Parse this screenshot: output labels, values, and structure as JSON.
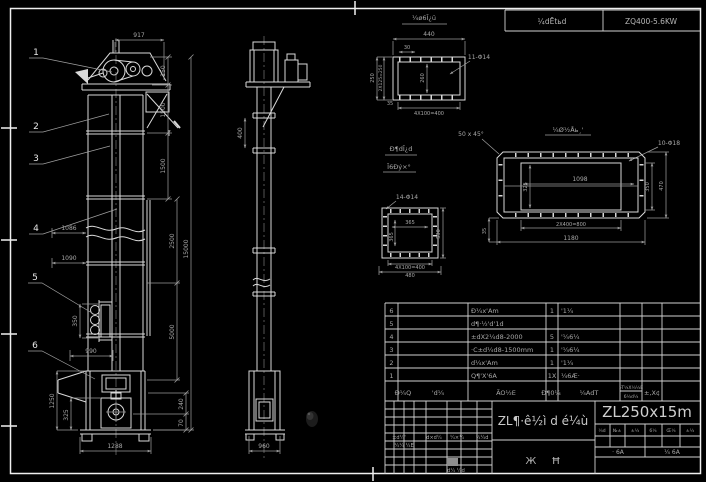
{
  "plate": {
    "left": "¼dĒtьd",
    "right": "ZQ400-5.6KW"
  },
  "front": {
    "callouts": [
      "1",
      "2",
      "3",
      "4",
      "5",
      "6"
    ],
    "section_mark": "I",
    "dims": {
      "w917": "917",
      "h150": "150",
      "h1500a": "1500",
      "h1500b": "1500",
      "v2500": "2500",
      "v5000": "5000",
      "v15000": "15000",
      "d1086": "1086",
      "d1090": "1090",
      "door350": "350",
      "d990": "990",
      "v1250": "1250",
      "v325": "325",
      "v240": "240",
      "v70": "70",
      "base1288": "1288"
    }
  },
  "side": {
    "dims": {
      "v400": "400",
      "base960": "960"
    }
  },
  "detail_a": {
    "title": "¼ø6Ī¿ü",
    "holes": "11-Φ14",
    "dims": {
      "w440": "440",
      "o30": "30",
      "i260": "260",
      "l250": "250",
      "l2x125": "2X125=250",
      "s35": "35",
      "b4x100": "4X100=400"
    }
  },
  "detail_b": {
    "title": "¼Ø½Åь¸'",
    "chamfer": "50 x 45°",
    "holes": "10-Φ18",
    "dims": {
      "i1098": "1098",
      "i325": "325",
      "r350": "350",
      "r470": "470",
      "b2x400": "2X400=800",
      "b1180": "1180",
      "l35": "35"
    }
  },
  "detail_c": {
    "title1": "Đ¶dĪ¿d",
    "title2": "Ī6Đý×°",
    "holes": "14-Φ14",
    "dims": {
      "iw": "365",
      "ih": "365",
      "r530": "530",
      "b1": "4X100=400",
      "b2": "480"
    }
  },
  "bom": {
    "header": {
      "no": "Đ¼Q",
      "code": "'d¼",
      "name": "ÃO½E",
      "qty": "Đ¶0¼",
      "material": "¼AdT",
      "weight_unit": "»T¼X¼½E",
      "weight_total": "6¼d¼",
      "remark": "±,X¢"
    },
    "rows": [
      {
        "no": "6",
        "code": "",
        "name": "Đ¼x'Am",
        "qty": "1",
        "material": "'1¼"
      },
      {
        "no": "5",
        "code": "",
        "name": "d¶·½'d'1d",
        "qty": "",
        "material": ""
      },
      {
        "no": "4",
        "code": "",
        "name": "±dX2¼d8-2000",
        "qty": "5",
        "material": "'¼6¼"
      },
      {
        "no": "3",
        "code": "",
        "name": "·C±d¼d8-1500mm",
        "qty": "1",
        "material": "'¼6¼"
      },
      {
        "no": "2",
        "code": "",
        "name": "d¼x'Am",
        "qty": "1",
        "material": "'1¼"
      },
      {
        "no": "1",
        "code": "",
        "name": "Q¶'X'6A",
        "qty": "1X",
        "material": "¼6Æ·"
      }
    ]
  },
  "title_block": {
    "product": "ZL¶·ê½ì d é¼ù",
    "type_label": "Ж Ħ",
    "drawing_no": "ZL250x15m",
    "rev_row": [
      "±d¼'",
      "d×d¼",
      "¼×¼",
      "¼¼d"
    ],
    "rev_row2": "¼¼ ¼E",
    "rev_bottom": "d¼ ¼d",
    "mini": [
      "¼d",
      "№±",
      "±¼",
      "6¼",
      "Œ¼",
      "±¼"
    ],
    "sheet_left": "· 6A",
    "sheet_right": "¼ 6A"
  },
  "colors": {
    "background": "#000000",
    "linework": "#d9d9d9",
    "dim_text": "#a8a8a8"
  }
}
